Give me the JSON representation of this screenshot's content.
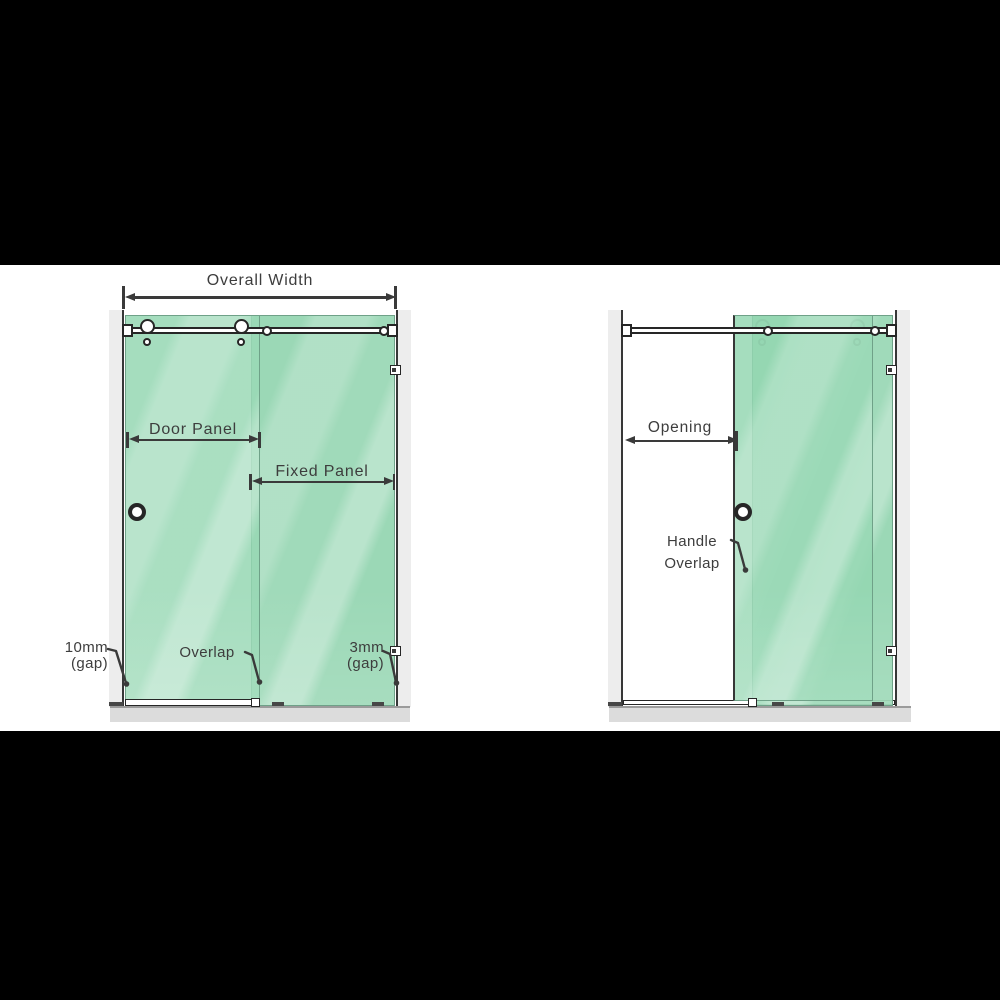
{
  "colors": {
    "glass_green": "#92d5b0",
    "glass_highlight": "#bde7d0",
    "wall_gray": "#ededed",
    "floor_gray": "#dcdcdc",
    "line_dark": "#2f2f2f",
    "text_gray": "#3d3d3d",
    "background_black": "#000000",
    "canvas_white": "#ffffff"
  },
  "left_view": {
    "dim_overall_width": "Overall Width",
    "dim_door_panel": "Door Panel",
    "dim_fixed_panel": "Fixed Panel",
    "label_gap_left_value": "10mm",
    "label_gap_left_unit": "(gap)",
    "label_overlap": "Overlap",
    "label_gap_right_value": "3mm",
    "label_gap_right_unit": "(gap)"
  },
  "right_view": {
    "dim_opening": "Opening",
    "label_handle_overlap_line1": "Handle",
    "label_handle_overlap_line2": "Overlap"
  }
}
